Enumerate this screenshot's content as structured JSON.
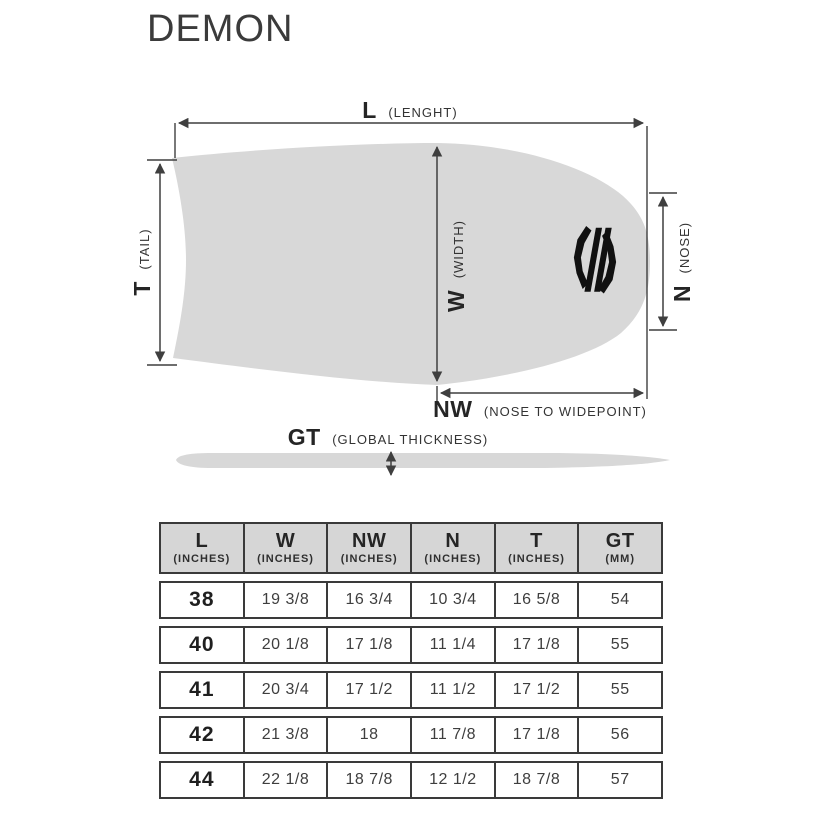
{
  "title": "DEMON",
  "diagram": {
    "board_color": "#d8d8d8",
    "line_color": "#3f3f3f",
    "logo_icon": "sniper-brand-emblem",
    "labels": {
      "length": {
        "abbr": "L",
        "paren": "(LENGHT)"
      },
      "tail": {
        "abbr": "T",
        "paren": "(TAIL)"
      },
      "width": {
        "abbr": "W",
        "paren": "(WIDTH)"
      },
      "nose": {
        "abbr": "N",
        "paren": "(NOSE)"
      },
      "nose_to_widepoint": {
        "abbr": "NW",
        "paren": "(NOSE TO WIDEPOINT)"
      },
      "global_thickness": {
        "abbr": "GT",
        "paren": "(GLOBAL THICKNESS)"
      }
    }
  },
  "table": {
    "columns": [
      {
        "abbr": "L",
        "unit": "(INCHES)"
      },
      {
        "abbr": "W",
        "unit": "(INCHES)"
      },
      {
        "abbr": "NW",
        "unit": "(INCHES)"
      },
      {
        "abbr": "N",
        "unit": "(INCHES)"
      },
      {
        "abbr": "T",
        "unit": "(INCHES)"
      },
      {
        "abbr": "GT",
        "unit": "(MM)"
      }
    ],
    "rows": [
      [
        "38",
        "19 3/8",
        "16 3/4",
        "10 3/4",
        "16 5/8",
        "54"
      ],
      [
        "40",
        "20 1/8",
        "17 1/8",
        "11 1/4",
        "17 1/8",
        "55"
      ],
      [
        "41",
        "20 3/4",
        "17 1/2",
        "11 1/2",
        "17 1/2",
        "55"
      ],
      [
        "42",
        "21 3/8",
        "18",
        "11 7/8",
        "17 1/8",
        "56"
      ],
      [
        "44",
        "22 1/8",
        "18 7/8",
        "12 1/2",
        "18 7/8",
        "57"
      ]
    ]
  }
}
